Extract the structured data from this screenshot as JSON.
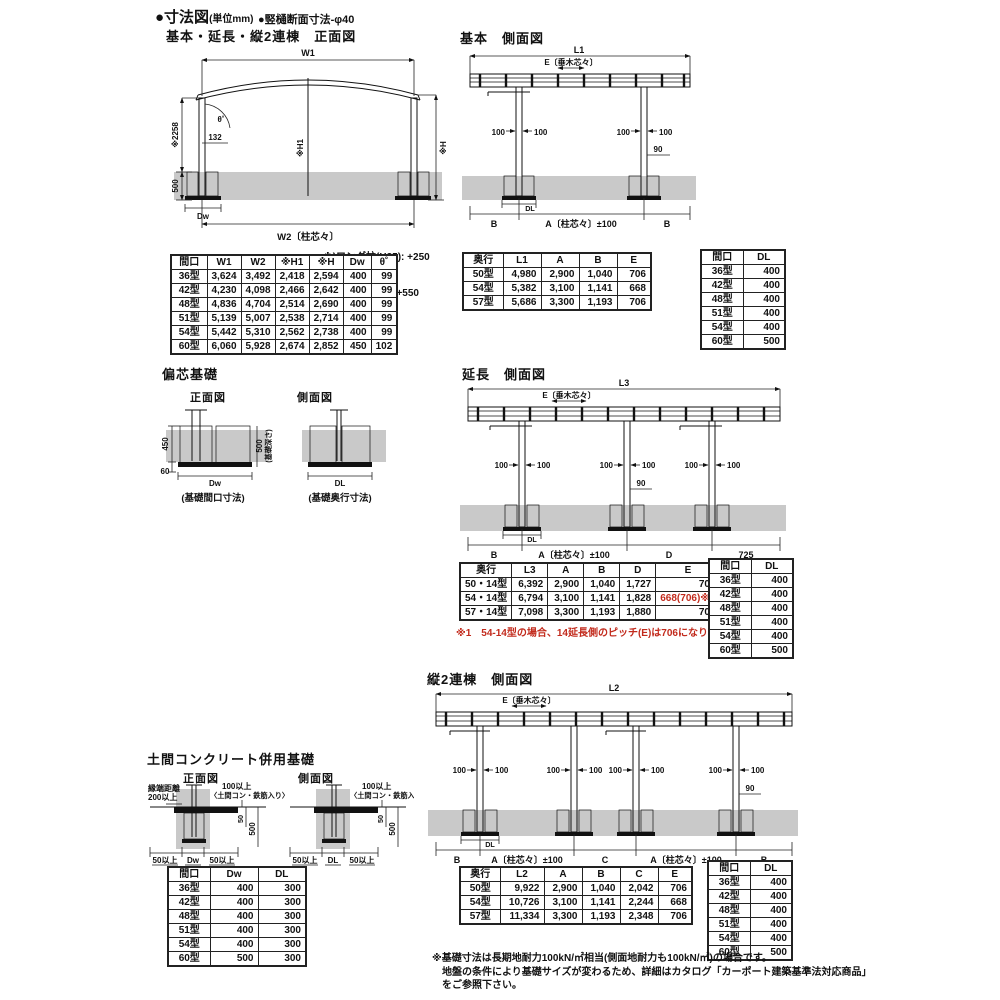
{
  "header": {
    "title": "●寸法図",
    "unit": "(単位mm)",
    "sub": "●竪樋断面寸法-φ40"
  },
  "common": {
    "d100": "100",
    "d90": "90",
    "b": "B",
    "a_span": "A〔柱芯々〕±100",
    "e_span": "E〔垂木芯々〕",
    "dl": "DL",
    "dw": "Dw"
  },
  "front": {
    "title": "基本・延長・縦2連棟　正面図",
    "labels": {
      "w1": "W1",
      "w2": "W2〔柱芯々〕",
      "h1": "※H1",
      "h": "※H",
      "v2258": "※2258",
      "v500": "500",
      "v132": "132",
      "theta": "θ˚"
    },
    "note1": "※)ロング柱(H25): +250",
    "note2": "H28柱(H28): +550",
    "table": {
      "headers": [
        "間口",
        "W1",
        "W2",
        "※H1",
        "※H",
        "Dw",
        "θ˚"
      ],
      "rows": [
        [
          "36型",
          "3,624",
          "3,492",
          "2,418",
          "2,594",
          "400",
          "99"
        ],
        [
          "42型",
          "4,230",
          "4,098",
          "2,466",
          "2,642",
          "400",
          "99"
        ],
        [
          "48型",
          "4,836",
          "4,704",
          "2,514",
          "2,690",
          "400",
          "99"
        ],
        [
          "51型",
          "5,139",
          "5,007",
          "2,538",
          "2,714",
          "400",
          "99"
        ],
        [
          "54型",
          "5,442",
          "5,310",
          "2,562",
          "2,738",
          "400",
          "99"
        ],
        [
          "60型",
          "6,060",
          "5,928",
          "2,674",
          "2,852",
          "450",
          "102"
        ]
      ]
    }
  },
  "basic_side": {
    "title": "基本　側面図",
    "labels": {
      "l1": "L1"
    },
    "table": {
      "headers": [
        "奥行",
        "L1",
        "A",
        "B",
        "E"
      ],
      "rows": [
        [
          "50型",
          "4,980",
          "2,900",
          "1,040",
          "706"
        ],
        [
          "54型",
          "5,382",
          "3,100",
          "1,141",
          "668"
        ],
        [
          "57型",
          "5,686",
          "3,300",
          "1,193",
          "706"
        ]
      ]
    }
  },
  "maguchi_dl": {
    "headers": [
      "間口",
      "DL"
    ],
    "rows": [
      [
        "36型",
        "400"
      ],
      [
        "42型",
        "400"
      ],
      [
        "48型",
        "400"
      ],
      [
        "51型",
        "400"
      ],
      [
        "54型",
        "400"
      ],
      [
        "60型",
        "500"
      ]
    ]
  },
  "henshin": {
    "title": "偏芯基礎",
    "front_label": "正面図",
    "side_label": "側面図",
    "labels": {
      "v450": "450",
      "v60": "60",
      "v500": "500",
      "depth": "(基礎深さ)",
      "cap_front": "(基礎間口寸法)",
      "cap_side": "(基礎奥行寸法)"
    }
  },
  "ext_side": {
    "title": "延長　側面図",
    "labels": {
      "l3": "L3",
      "d": "D",
      "v725": "725"
    },
    "table": {
      "headers": [
        "奥行",
        "L3",
        "A",
        "B",
        "D",
        "E"
      ],
      "rows": [
        [
          "50・14型",
          "6,392",
          "2,900",
          "1,040",
          "1,727",
          "706"
        ],
        [
          "54・14型",
          "6,794",
          "3,100",
          "1,141",
          "1,828",
          "668(706)※1"
        ],
        [
          "57・14型",
          "7,098",
          "3,300",
          "1,193",
          "1,880",
          "706"
        ]
      ]
    },
    "red_note": "※1　54-14型の場合、14延長側のピッチ(E)は706になります。"
  },
  "double_side": {
    "title": "縦2連棟　側面図",
    "labels": {
      "l2": "L2",
      "c": "C"
    },
    "table": {
      "headers": [
        "奥行",
        "L2",
        "A",
        "B",
        "C",
        "E"
      ],
      "rows": [
        [
          "50型",
          "9,922",
          "2,900",
          "1,040",
          "2,042",
          "706"
        ],
        [
          "54型",
          "10,726",
          "3,100",
          "1,141",
          "2,244",
          "668"
        ],
        [
          "57型",
          "11,334",
          "3,300",
          "1,193",
          "2,348",
          "706"
        ]
      ]
    }
  },
  "doma": {
    "title": "土間コンクリート併用基礎",
    "front_label": "正面図",
    "side_label": "側面図",
    "labels": {
      "edge1": "縁端距離",
      "edge2": "200以上",
      "over100": "100以上",
      "rebar": "〈土間コン・鉄筋入り〉",
      "v50": "50",
      "v500": "500",
      "over50": "50以上"
    },
    "table": {
      "headers": [
        "間口",
        "Dw",
        "DL"
      ],
      "rows": [
        [
          "36型",
          "400",
          "300"
        ],
        [
          "42型",
          "400",
          "300"
        ],
        [
          "48型",
          "400",
          "300"
        ],
        [
          "51型",
          "400",
          "300"
        ],
        [
          "54型",
          "400",
          "300"
        ],
        [
          "60型",
          "500",
          "300"
        ]
      ]
    }
  },
  "footnote": {
    "l1": "※基礎寸法は長期地耐力100kN/㎡相当(側面地耐力も100kN/㎡)の場合です。",
    "l2": "地盤の条件により基礎サイズが変わるため、詳細はカタログ「カーポート建築基準法対応商品」",
    "l3": "をご参照下さい。"
  },
  "colors": {
    "accent_red": "#c22a1c",
    "ground_gray": "#c9c9c9",
    "line": "#111111"
  }
}
